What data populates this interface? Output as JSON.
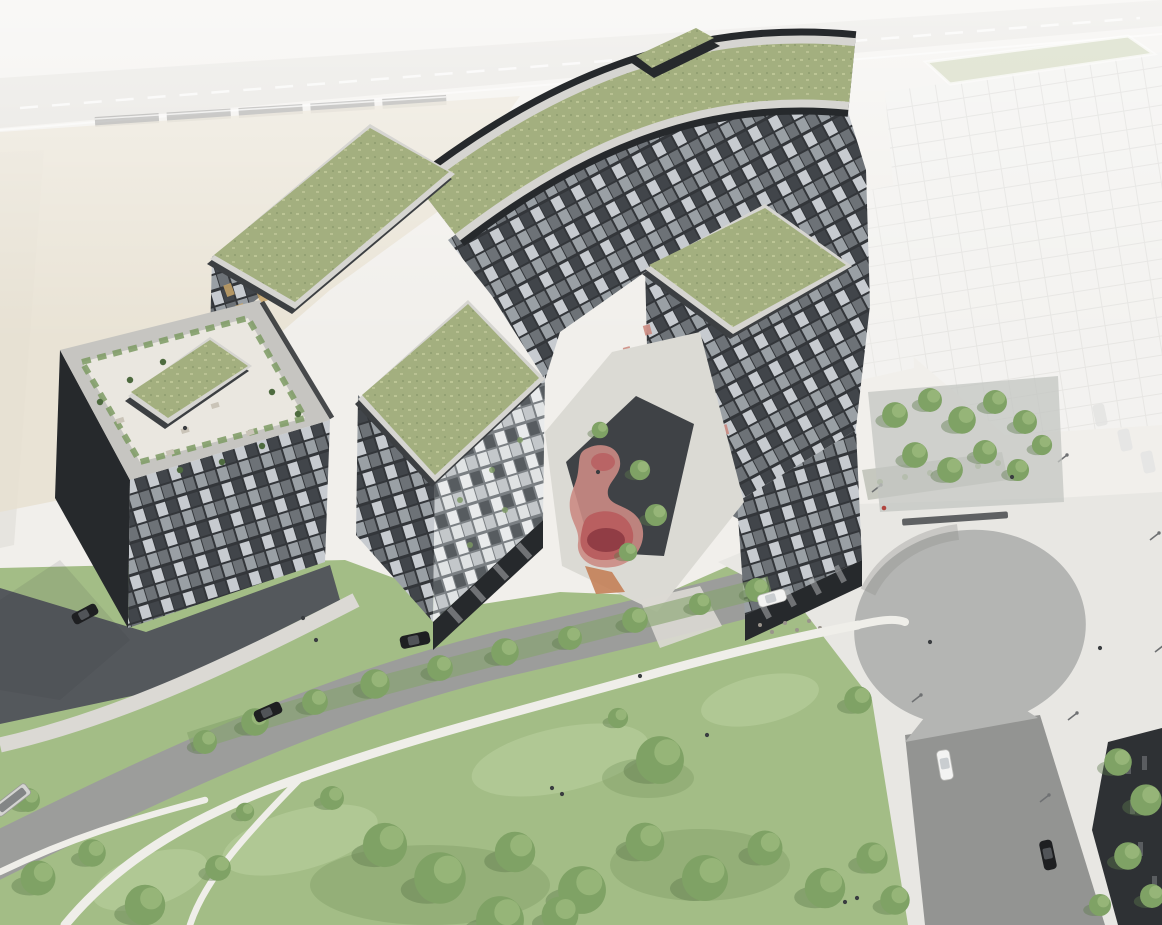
{
  "scene": {
    "type": "architectural-aerial-rendering",
    "description": "Bird's-eye architectural rendering of a dark charcoal residential block complex with green sedum roofs, a rooftop terrace with planting and furniture, an inner courtyard with an organic pink playground, a park with winding white paths and trees, a curved street with cars, a teardrop-shaped paved plaza with a road, a tree grove, a faded future-phase building, and a railway line with a train in the washed-out background.",
    "colors": {
      "bg": "#f1efeb",
      "field": "#e7e0cf",
      "roadPale": "#dcd9d3",
      "laneWhite": "#ffffff",
      "trainGray": "#6f6f6d",
      "grass": "#a3bd86",
      "grassLight": "#c2d4a6",
      "grassShade": "#7e9c63",
      "treeBody": "#7fa265",
      "treeLight": "#a9c489",
      "treeShade": "#5d7a4c",
      "hedge": "#86a46c",
      "pathWhite": "#efeee9",
      "street": "#9c9d9b",
      "curb": "#e8e6e1",
      "plaza": "#e8e7e3",
      "asphalt": "#b4b5b3",
      "asphaltShade": "#8e8f8d",
      "roadDark": "#939492",
      "forecourt": "#54585c",
      "walkway": "#dbd9d4",
      "facadeDark": "#33363a",
      "facadeDeep": "#26292c",
      "facadeMid": "#6d7277",
      "windowLight": "#c7cbd0",
      "windowWhite": "#e9ebec",
      "windowAmber": "#c8a469",
      "accentPink": "#c97f74",
      "greenRoof": "#a3af7f",
      "greenRoofLight": "#c2ca9b",
      "roofShadow": "#3c3f42",
      "parapet": "#d6d5d1",
      "terraceFloor": "#eae7e0",
      "terraceFurn": "#cac4b8",
      "planter": "#7d9a63",
      "cypress": "#4e6b3f",
      "ghostFill": "#f6f6f5",
      "ghostLine": "#c9c9c7",
      "ghostRoof": "#c6cfab",
      "grovePave": "#c3c5c1",
      "courtPave": "#dbdad4",
      "courtDark": "#3f4246",
      "playOuter": "#cb8b84",
      "playMid": "#b95f60",
      "playDeep": "#8d3a42",
      "playOrange": "#c27a50",
      "carDark": "#1e1f21",
      "carGlass": "#5a5e62",
      "carWhite": "#f3f3f2",
      "busBody": "#d4d4d1",
      "people": "#3a3d40",
      "personRed": "#b0453f",
      "lamp": "#6f7173",
      "bench": "#5f6163",
      "darkBuilding": "#2e3134"
    },
    "objects": {
      "buildings": {
        "main_complex": {
          "facade": "dark charcoal with irregular checkered window grid",
          "green_roofs": 6,
          "roof_terrace": {
            "present": true,
            "plants": 10,
            "furniture_pieces": 6
          },
          "penthouse_boxes": 2,
          "arcades": 2,
          "amber_windows": 5,
          "pink_facade_accents": 8
        },
        "ghost_building": {
          "style": "faded white future phase",
          "green_roof": true,
          "parked_cars_faint": 3
        },
        "corner_building": {
          "style": "dark",
          "position": "bottom-right"
        }
      },
      "courtyard": {
        "playground_colors": [
          "salmon",
          "red",
          "dark-red",
          "orange"
        ],
        "dark_paving": true,
        "trees": 4
      },
      "landscape": {
        "park_lawn": true,
        "park_trees": 22,
        "street_trees": 10,
        "grove_trees": 10,
        "corner_trees": 5,
        "white_paths": 4
      },
      "infrastructure": {
        "teardrop_plaza": true,
        "plaza_road": true,
        "curved_street": true,
        "railway_with_train": true,
        "lamp_posts": 8,
        "benches": 1,
        "planter_strip": true
      },
      "vehicles": {
        "dark_cars": 4,
        "white_cars": 2,
        "buses": 1
      },
      "people": 14
    }
  }
}
